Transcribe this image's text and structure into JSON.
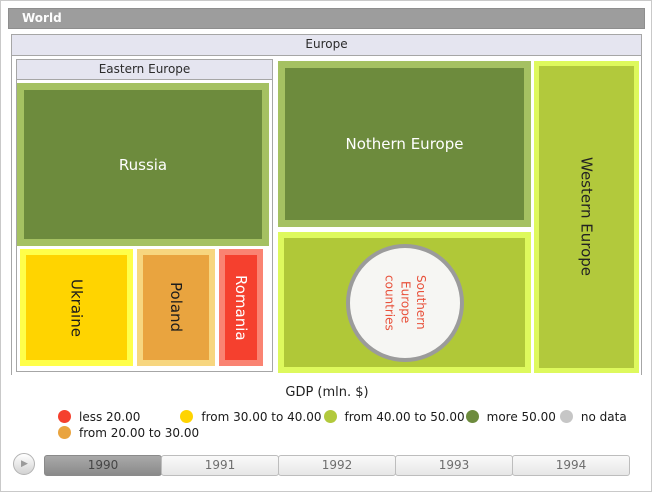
{
  "breadcrumb": {
    "world_label": "World"
  },
  "treemap": {
    "europe_label": "Europe",
    "eastern_label": "Eastern Europe",
    "russia_label": "Russia",
    "ukraine_label": "Ukraine",
    "poland_label": "Poland",
    "romania_label": "Romania",
    "northern_label": "Nothern Europe",
    "southern_label": "Southern Europe countries",
    "western_label": "Western Europe"
  },
  "legend": {
    "title": "GDP (mln. $)",
    "items": [
      {
        "label": "less 20.00",
        "color": "#f5402e"
      },
      {
        "label": "from 30.00 to 40.00",
        "color": "#ffd400"
      },
      {
        "label": "from 40.00 to 50.00",
        "color": "#b2c93c"
      },
      {
        "label": "more 50.00",
        "color": "#6d8b3d"
      },
      {
        "label": "no data",
        "color": "#c6c6c6"
      },
      {
        "label": "from 20.00 to 30.00",
        "color": "#e9a43f"
      }
    ]
  },
  "timeline": {
    "years": [
      "1990",
      "1991",
      "1992",
      "1993",
      "1994"
    ],
    "selected_year": "1990",
    "play_icon": "▶"
  },
  "colors": {
    "dark_green_fill": "#6d8b3d",
    "dark_green_border": "#a5c162",
    "yellow_green_fill": "#b2c93c",
    "yellow_green_border": "#def95d",
    "yellow_fill": "#ffd400",
    "yellow_border": "#ffff4a",
    "orange_fill": "#e9a43f",
    "orange_border": "#f7d67f",
    "red_fill": "#f5402e",
    "red_border": "#fa8372",
    "panel_header_bg": "#e5e5f0",
    "world_bar_bg": "#9d9d9d",
    "circle_fill": "#f6f6f3",
    "circle_border": "#9b9b9b",
    "circle_text": "#e8523c"
  },
  "chart_data": {
    "type": "treemap",
    "title": "GDP (mln. $)",
    "breadcrumb_root": "World",
    "current_level": "Europe",
    "selected_year": "1990",
    "timeline_years": [
      "1990",
      "1991",
      "1992",
      "1993",
      "1994"
    ],
    "legend_bins": [
      {
        "label": "less 20.00",
        "color": "#f5402e"
      },
      {
        "label": "from 20.00 to 30.00",
        "color": "#e9a43f"
      },
      {
        "label": "from 30.00 to 40.00",
        "color": "#ffd400"
      },
      {
        "label": "from 40.00 to 50.00",
        "color": "#b2c93c"
      },
      {
        "label": "more 50.00",
        "color": "#6d8b3d"
      },
      {
        "label": "no data",
        "color": "#c6c6c6"
      }
    ],
    "legend_position": "bottom",
    "tree": {
      "name": "Europe",
      "children": [
        {
          "name": "Eastern Europe",
          "children": [
            {
              "name": "Russia",
              "gdp_bin": "more 50.00",
              "color": "#6d8b3d",
              "relative_size": "largest"
            },
            {
              "name": "Ukraine",
              "gdp_bin": "from 30.00 to 40.00",
              "color": "#ffd400",
              "relative_size": "medium"
            },
            {
              "name": "Poland",
              "gdp_bin": "from 20.00 to 30.00",
              "color": "#e9a43f",
              "relative_size": "small"
            },
            {
              "name": "Romania",
              "gdp_bin": "less 20.00",
              "color": "#f5402e",
              "relative_size": "smallest"
            }
          ]
        },
        {
          "name": "Nothern Europe",
          "gdp_bin": "more 50.00",
          "color": "#6d8b3d"
        },
        {
          "name": "Southern Europe countries",
          "gdp_bin": "from 40.00 to 50.00",
          "color": "#b2c93c",
          "shape": "circle-marker"
        },
        {
          "name": "Western Europe",
          "gdp_bin": "from 40.00 to 50.00",
          "color": "#b2c93c"
        }
      ]
    }
  }
}
